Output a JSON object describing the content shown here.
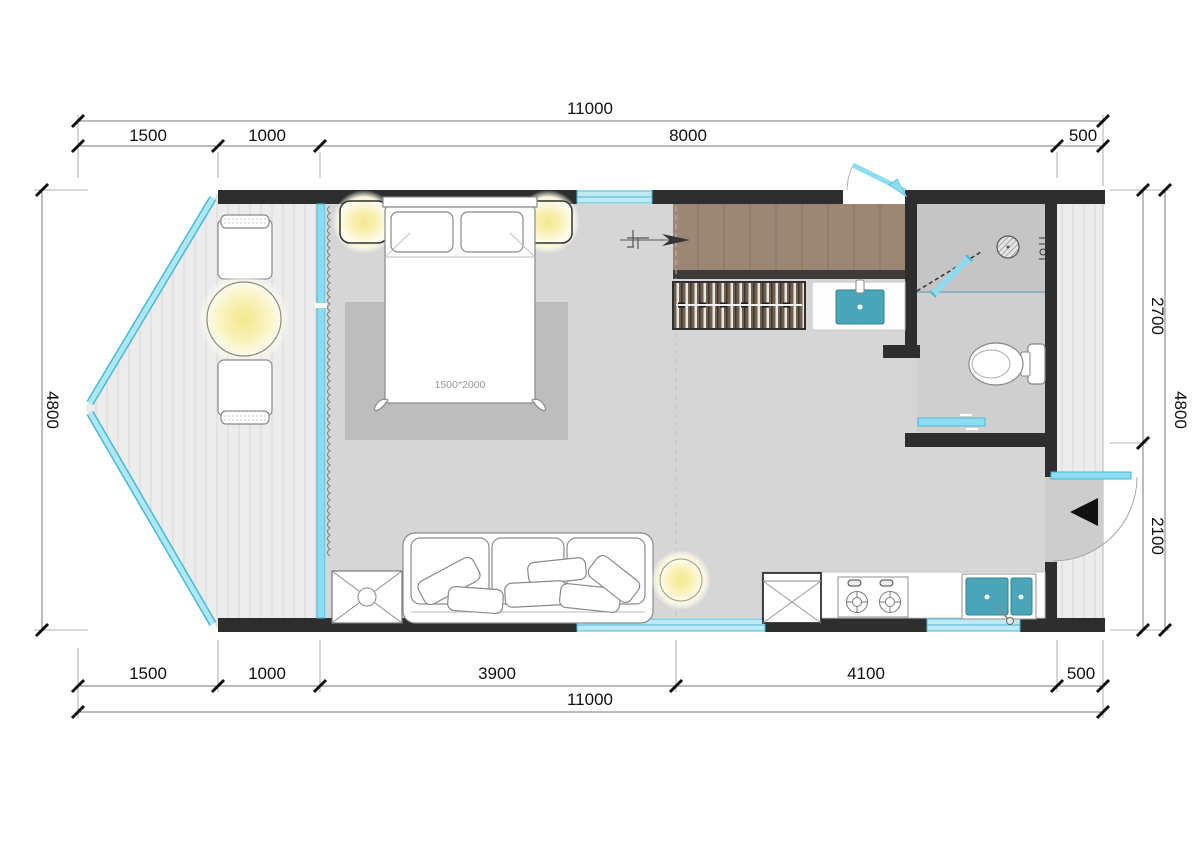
{
  "dims": {
    "top": {
      "total": "11000",
      "segments": [
        "1500",
        "1000",
        "8000",
        "500"
      ]
    },
    "bottom": {
      "total": "11000",
      "segments": [
        "1500",
        "1000",
        "3900",
        "4100",
        "500"
      ]
    },
    "left": {
      "total": "4800"
    },
    "right": {
      "total": "4800",
      "segments": [
        "2700",
        "2100"
      ]
    }
  },
  "labels": {
    "bed_size": "1500*2000"
  },
  "colors": {
    "wall": "#2e2e2e",
    "glass": "#8edcef",
    "glass_dark": "#49b8d4",
    "window": "#bfe9f4",
    "floor": "#d6d6d6",
    "shower_floor": "#c5c5c5",
    "bath_floor": "#cfcfcf",
    "deck": "#ececec",
    "rug": "#bdbdbd",
    "closet_wood": "#9b8774",
    "sink_teal": "#4aa5b8",
    "lamp_glow": "#f4e78c",
    "entry_arrow": "#111111"
  }
}
